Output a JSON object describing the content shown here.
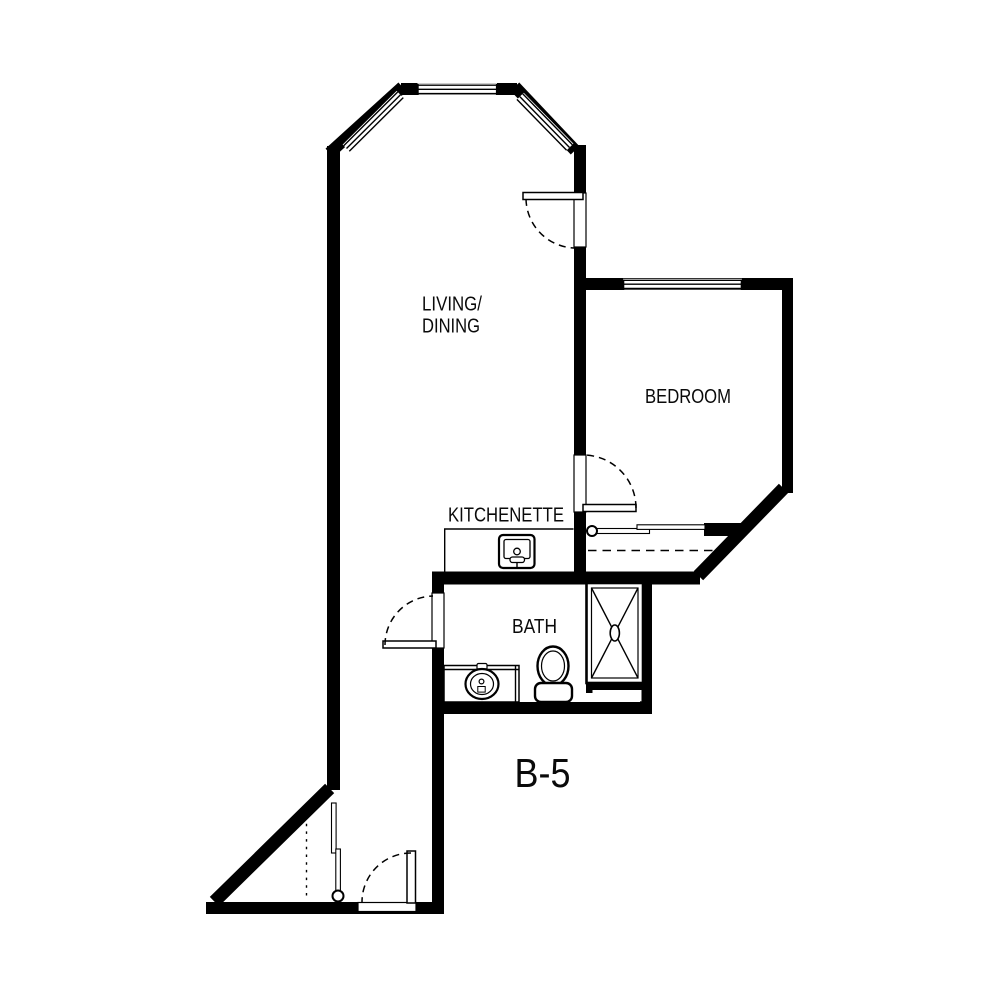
{
  "plan": {
    "unit_label": "B-5",
    "rooms": {
      "living_dining_line1": "LIVING/",
      "living_dining_line2": "DINING",
      "bedroom": "BEDROOM",
      "kitchenette": "KITCHENETTE",
      "bath": "BATH"
    },
    "colors": {
      "wall": "#000000",
      "background": "#ffffff",
      "text": "#000000"
    },
    "windows": [
      "bay-window-top",
      "bay-window-left",
      "bay-window-right",
      "bedroom-window"
    ],
    "doors": [
      "entry-door",
      "bath-door",
      "bedroom-door",
      "balcony-door"
    ],
    "fixtures": [
      "kitchenette-sink",
      "vanity-sink",
      "toilet",
      "shower",
      "bedroom-closet-rod",
      "entry-closet-rod"
    ]
  }
}
